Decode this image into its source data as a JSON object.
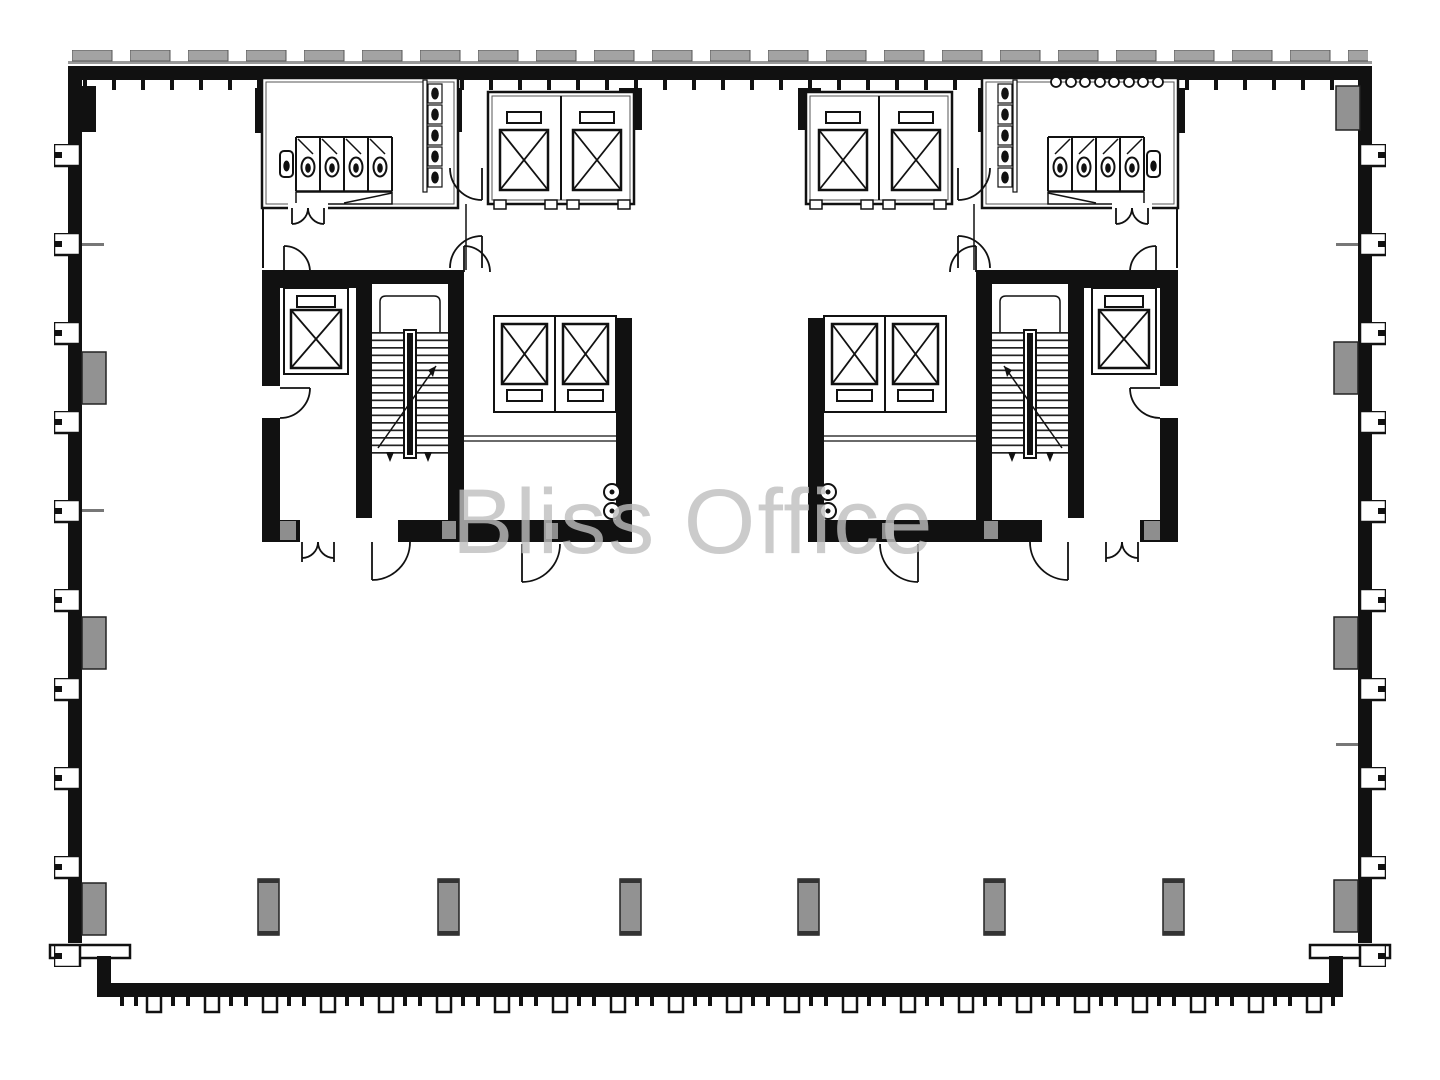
{
  "watermark": {
    "text": "Bliss Office",
    "color": "#bfbfbf"
  },
  "plan": {
    "type": "office-floor-plan",
    "colors": {
      "wall": "#111111",
      "column_gray": "#929292",
      "window_cap_gray": "#a3a3a3",
      "background": "#ffffff"
    },
    "elements": {
      "elevators": 8,
      "stairwells": 2,
      "restrooms": 2,
      "toilet_stalls_per_restroom": 4,
      "wall_urinals_per_restroom": 5,
      "sinks_right_restroom": 8,
      "free_standing_columns": 6
    }
  }
}
